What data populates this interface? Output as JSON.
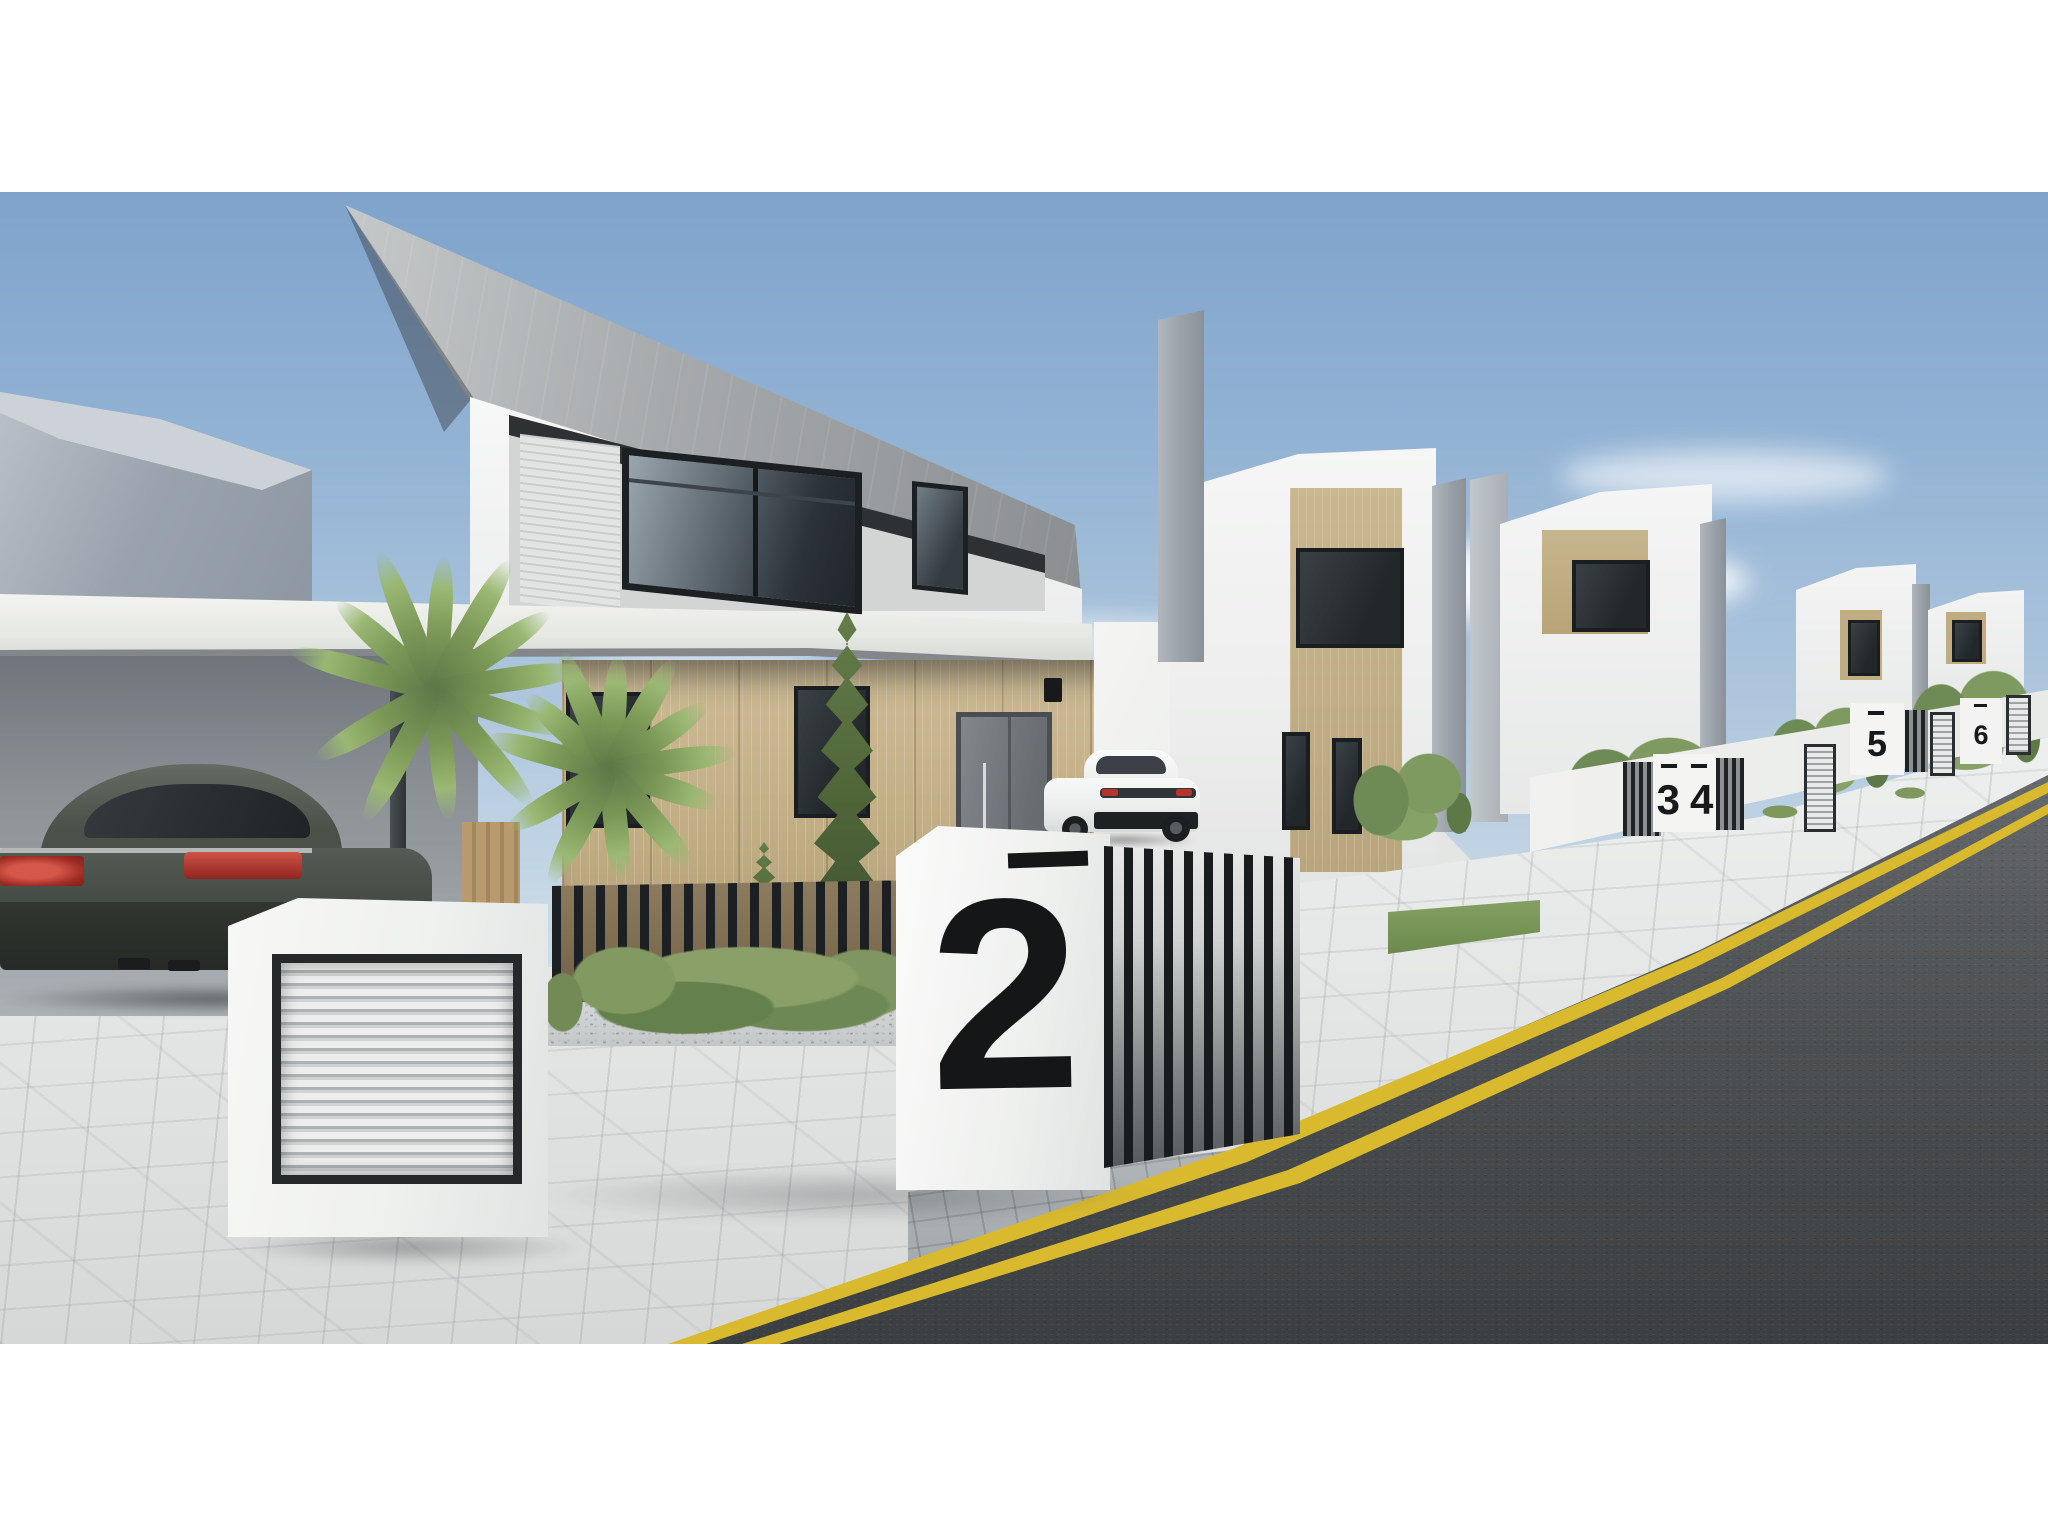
{
  "scene": {
    "type": "3D architectural exterior render",
    "description": "Street view of a modern residential development: white two-storey villas with timber cladding accents, cantilevered concrete roofs, carports, landscaped front yards, white boundary walls with numbered gate pillars, paved sidewalk and an asphalt road with double yellow lines under a blue sky.",
    "house_numbers": [
      "2",
      "3",
      "4",
      "5",
      "6"
    ],
    "vehicles": [
      {
        "name": "dark saloon car",
        "location": "carport on the left"
      },
      {
        "name": "white sports coupe",
        "location": "driveway of the neighbouring villa"
      }
    ],
    "landscaping": [
      "palm trees",
      "cypress trees",
      "fern shrubs",
      "hedge trees",
      "pebble bed"
    ],
    "road_marking": "double yellow lines",
    "frame": {
      "letterbox": "white bands above and below the render"
    }
  },
  "palette": {
    "sky_top": "#7fa3cc",
    "sky_horizon": "#eff3f5",
    "facade_white": "#f2f3f2",
    "concrete_grey": "#9aa0a5",
    "timber_cladding": "#c2ae85",
    "window_glass": "#2b3238",
    "gate_black": "#1d2023",
    "foliage_green": "#6f8a55",
    "pavement_grey": "#e4e6e5",
    "asphalt_grey": "#4b4e50",
    "line_yellow": "#d9ba2e",
    "taillight_red": "#b5342c",
    "letterbox_white": "#ffffff"
  }
}
